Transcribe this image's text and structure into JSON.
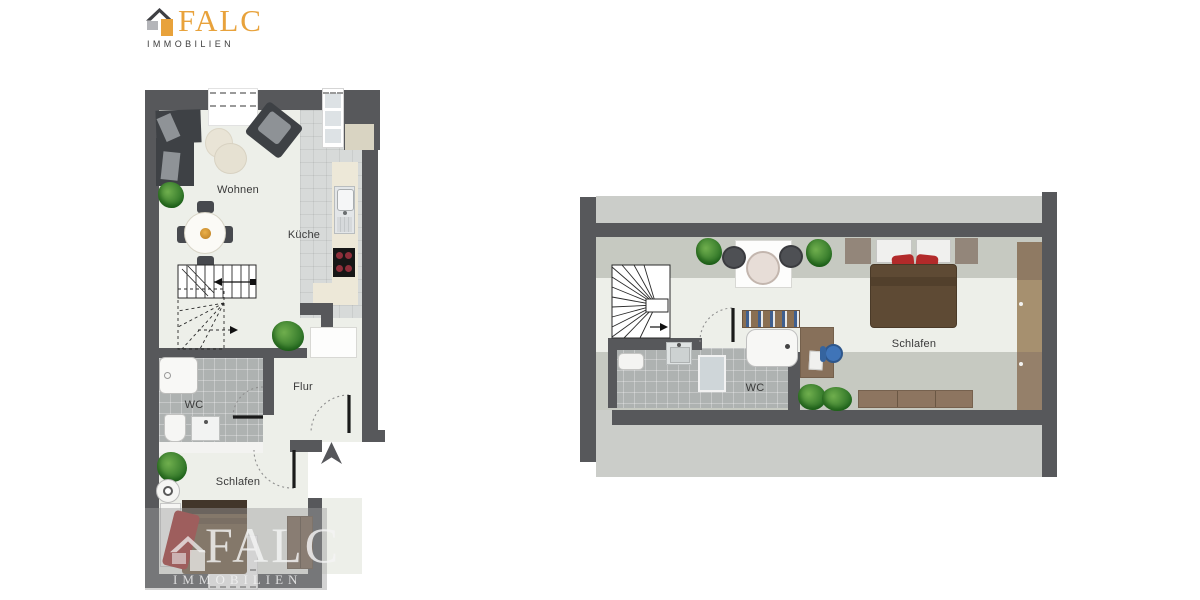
{
  "logo": {
    "brand": "FALC",
    "subtitle": "IMMOBILIEN"
  },
  "watermark": {
    "brand": "FALC",
    "subtitle": "IMMOBILIEN"
  },
  "ground_floor": {
    "name": "ground-floor-plan",
    "rooms": [
      {
        "id": "wohnen",
        "label": "Wohnen"
      },
      {
        "id": "kueche",
        "label": "Küche"
      },
      {
        "id": "flur",
        "label": "Flur"
      },
      {
        "id": "wc",
        "label": "WC"
      },
      {
        "id": "schlafen",
        "label": "Schlafen"
      }
    ]
  },
  "upper_floor": {
    "name": "upper-floor-plan",
    "rooms": [
      {
        "id": "schlafen",
        "label": "Schlafen"
      },
      {
        "id": "wc",
        "label": "WC"
      }
    ]
  },
  "colors": {
    "wall": "#57585B",
    "floor": "#EDEFE9",
    "sloped_ceiling_zone": "#C6C9C1",
    "outside_roof_band": "#CBCDC9",
    "bath_tiles": "#AEB2B1",
    "kitchen_tiles": "#D7DAD9",
    "kitchen_counter": "#EDE8D8",
    "wood_dark": "#5E4A34",
    "wood_mid": "#8A7157",
    "wood_light": "#A6906F",
    "accent_red": "#B22A2A",
    "accent_blue": "#3F74B8",
    "plant_green": "#2E7427",
    "logo_orange": "#E8A23B",
    "logo_dark": "#3E3F43",
    "logo_gray": "#B4B5B9"
  }
}
